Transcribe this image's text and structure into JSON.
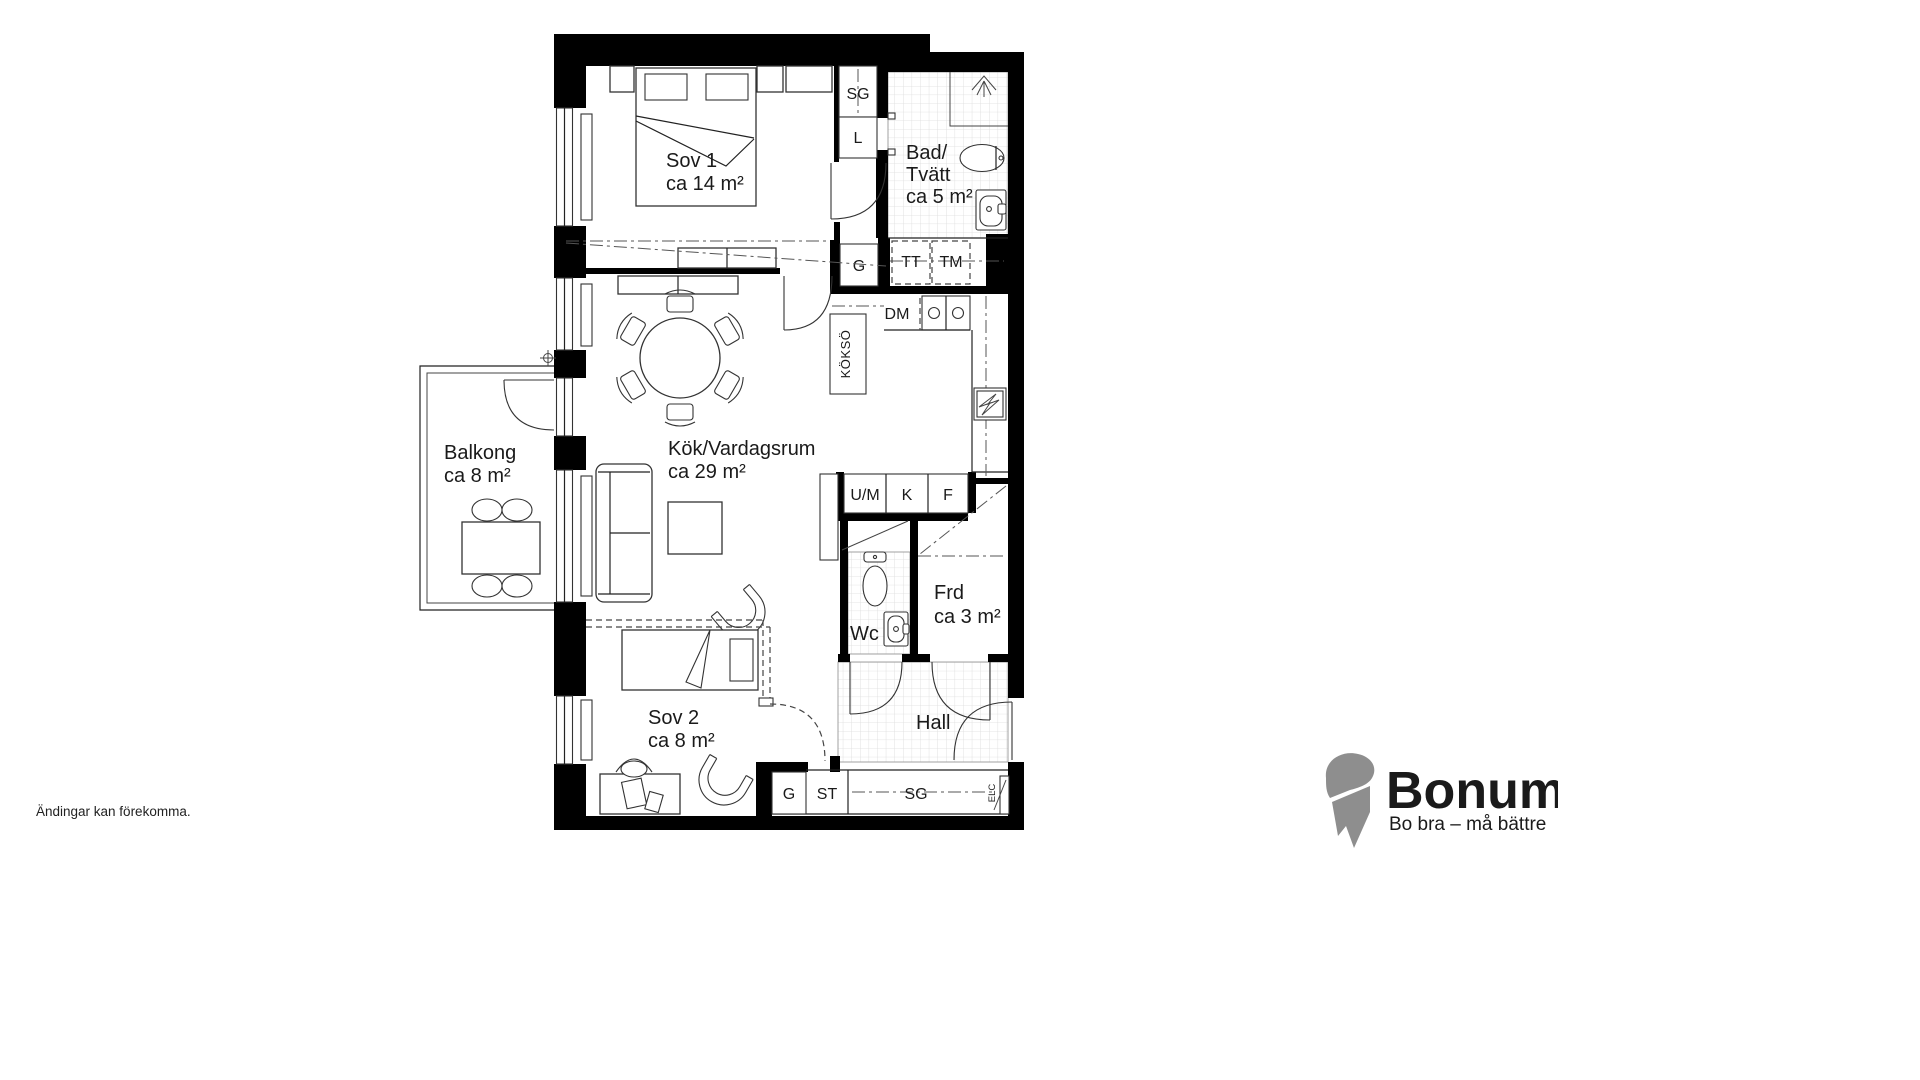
{
  "rooms": {
    "sov1": {
      "name": "Sov 1",
      "area": "ca 14 m²"
    },
    "bad": {
      "l1": "Bad/",
      "l2": "Tvätt",
      "area": "ca 5 m²"
    },
    "balkong": {
      "name": "Balkong",
      "area": "ca 8 m²"
    },
    "kok": {
      "name": "Kök/Vardagsrum",
      "area": "ca 29 m²"
    },
    "sov2": {
      "name": "Sov 2",
      "area": "ca 8 m²"
    },
    "frd": {
      "name": "Frd",
      "area": "ca 3 m²"
    },
    "wc": {
      "name": "Wc"
    },
    "hall": {
      "name": "Hall"
    }
  },
  "fixtures": {
    "sg_top": "SG",
    "linen": "L",
    "wardrobe_top": "G",
    "dryer": "TT",
    "washer": "TM",
    "dishwasher": "DM",
    "island": "KÖKSÖ",
    "oven_micro": "U/M",
    "fridge": "K",
    "freezer": "F",
    "wardrobe_sov2": "G",
    "cleaning": "ST",
    "wardrobe_hall": "SG",
    "electrical": "ELC"
  },
  "footer": {
    "disclaimer": "Ändingar kan förekomma."
  },
  "logo": {
    "brand": "Bonum",
    "tagline": "Bo bra – må bättre",
    "brand_color": "#F6A01A",
    "icon_color": "#8E8E8E",
    "tagline_color": "#3A3A3A"
  }
}
